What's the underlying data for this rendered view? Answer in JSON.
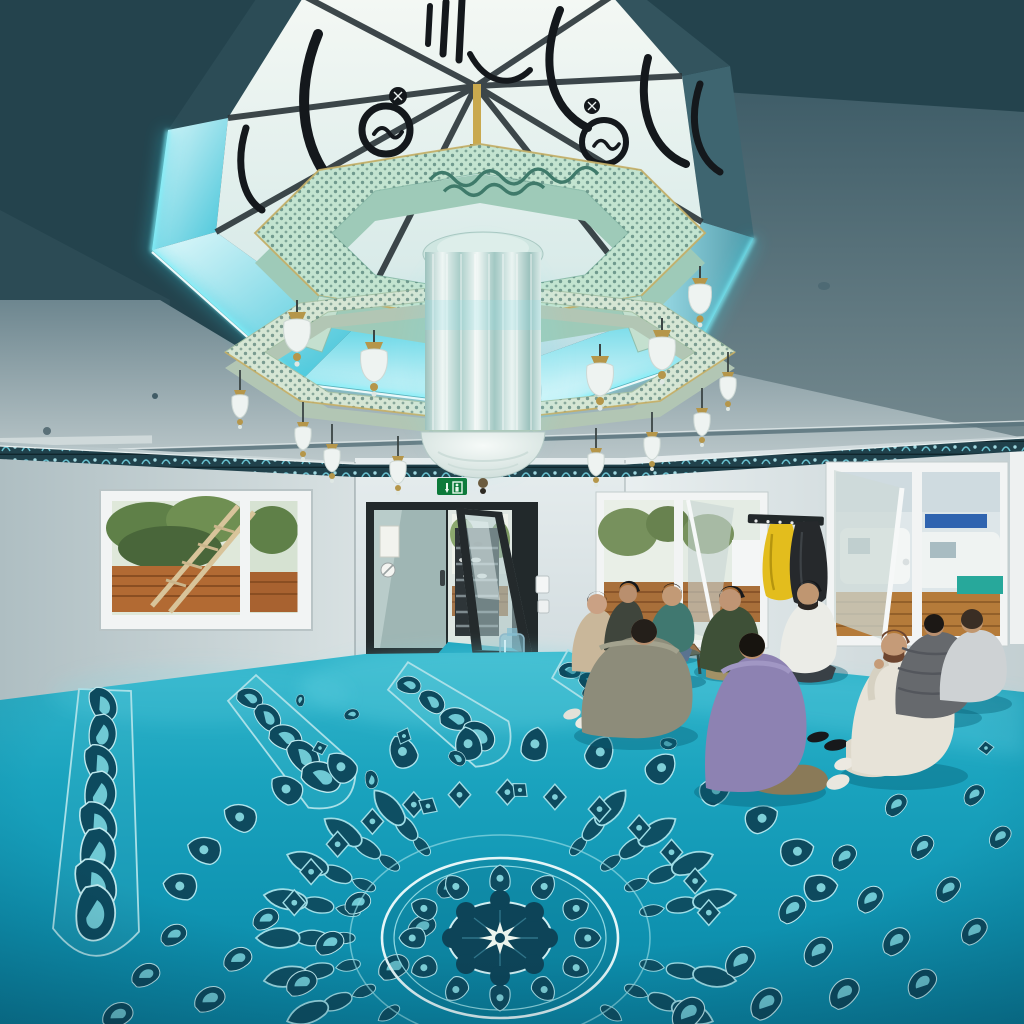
{
  "meta": {
    "description": "Photograph of a modern mosque prayer hall interior: an ornate octagonal chandelier hangs from a skylight decorated with black Arabic calligraphy on white stained glass, ringed by cyan LED cove lighting; below, a vivid turquoise carpet with a large ornamental medallion and runner borders; ten men sit in a discussion circle beside tilted-open windows; a glass double door reveals an entry hall with a shoe rack.",
    "scene_type": "photograph",
    "room": "mosque prayer hall"
  },
  "palette": {
    "ceiling_dark": "#24434d",
    "ceiling_light": "#93a6ad",
    "recess_glow_cyan": "#62e3f2",
    "skylight_glass": "#eef4f2",
    "calligraphy_black": "#14181c",
    "chandelier_metal_celadon": "#c3e4d0",
    "chandelier_gold": "#c2a355",
    "wall_gray": "#d6dfe1",
    "frieze_dark_teal": "#20414b",
    "carpet_turquoise": "#149cba",
    "carpet_motif_dark": "#0d4a5e",
    "carpet_motif_light": "#9fdde6",
    "door_frame_dark": "#232a2c",
    "exit_sign_green": "#0d7a3a",
    "jacket_yellow": "#e3bd1d",
    "jacket_black": "#26292c",
    "fence_orange": "#b26a33",
    "foliage_green": "#5f8048"
  },
  "skylight": {
    "shape": "octagonal recessed skylight",
    "glass_decoration": "black Arabic calligraphy roundels and crescents on white glass",
    "lighting": "cyan LED cove strip around rim",
    "center_fitting": "gold suspension rod and finial"
  },
  "chandelier": {
    "style": "Ottoman style two-tier pierced metal octagon",
    "metal_finish": "pale celadon lattice with gilt edges and calligraphy cartouche",
    "lamps_upper_tier": 5,
    "lamps_lower_tier": 8,
    "center": "crystal rod column with frosted cut-glass dome"
  },
  "walls": {
    "finish": "light gray paint",
    "frieze": "dark teal arabesque border band at ceiling line"
  },
  "windows": {
    "left_window_view": "green trees, wooden ladder, orange timber fence",
    "rear_window_view": "trees, fence and daylight, one sash tilted open",
    "right_window_view": "parked white vans, buildings, timber fence, sash tilted open"
  },
  "door": {
    "type": "dark framed glass double door, right leaf open",
    "signs": "paper notice and round sticker on left leaf",
    "above": "green emergency exit pictogram sign",
    "through_view": "entry hall with shoe rack shelves and bright windows",
    "floor_item": "translucent water container beside door"
  },
  "coat_rack": {
    "items": [
      "yellow rain jacket",
      "black jacket"
    ],
    "type": "wall rail with hooks"
  },
  "people": {
    "count": 10,
    "activity": "sitting cross-legged in a circle, talking",
    "clothing_colors": [
      "beige",
      "dark olive with cap",
      "teal with jeans",
      "dark green hoodie with cap",
      "white thobe with black cap",
      "olive gray",
      "purple polo",
      "cream sweater",
      "gray puffer",
      "light gray sweater"
    ],
    "extras": [
      "small wooden stool with open book",
      "black slippers on carpet",
      "white socks"
    ]
  },
  "carpet": {
    "color": "vivid turquoise",
    "pattern": "large central medallion with eight point star, radiating palmette rays, scalloped arc border, vertical runner strips with scroll motifs",
    "motif_colors": [
      "dark teal",
      "pale cyan outline"
    ]
  },
  "icons": {
    "exit_sign": "white running figure and down arrow on green"
  }
}
